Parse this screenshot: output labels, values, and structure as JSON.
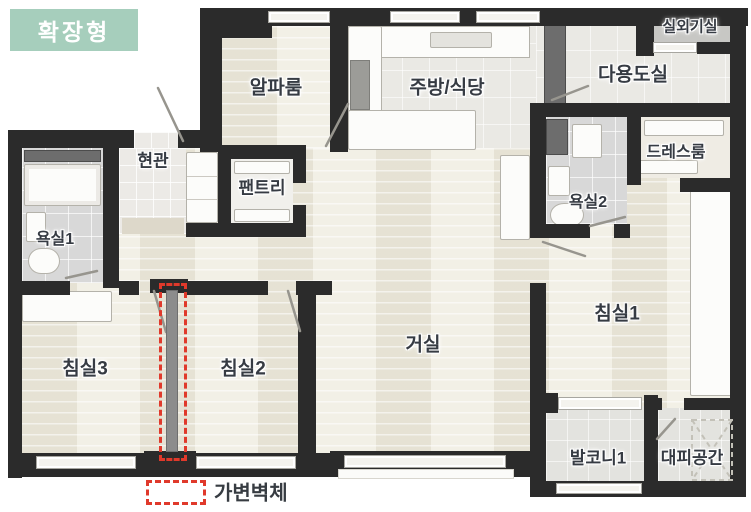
{
  "badge": {
    "label": "확장형"
  },
  "legend": {
    "label": "가변벽체"
  },
  "rooms": {
    "alpha": "알파룸",
    "kitchen": "주방/식당",
    "outdoor_unit": "실외기실",
    "utility": "다용도실",
    "dress": "드레스룸",
    "bath2": "욕실2",
    "bed1": "침실1",
    "balcony1": "발코니1",
    "evac": "대피공간",
    "entrance": "현관",
    "pantry": "팬트리",
    "bath1": "욕실1",
    "bed3": "침실3",
    "bed2": "침실2",
    "living": "거실"
  },
  "colors": {
    "badge_bg": "#a6cebc",
    "wall": "#2b2b2b",
    "legend_red": "#e0392b",
    "movable_wall_fill": "#8c8c8c",
    "wood_floor": "#edeadd"
  }
}
